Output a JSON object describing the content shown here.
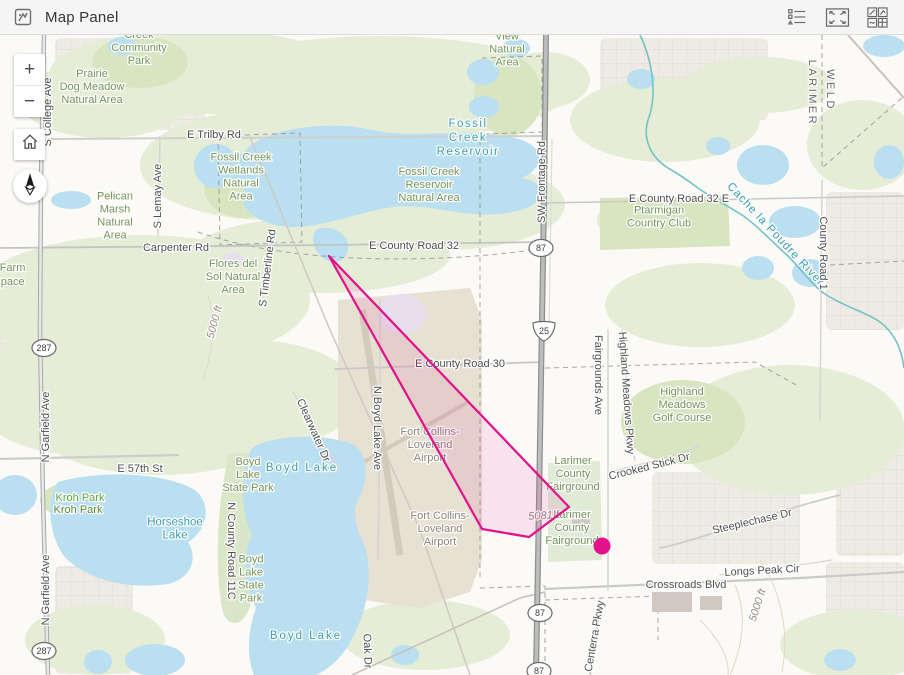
{
  "header": {
    "title": "Map Panel",
    "icons": {
      "panel": "map-panel-icon",
      "legend": "legend-icon",
      "fullscreen": "fullscreen-icon",
      "widgets": "widget-grid-icon"
    }
  },
  "controls": {
    "zoom_in": "+",
    "zoom_out": "−"
  },
  "colors": {
    "accent_pink": "#e2128a",
    "polygon_fill_opacity": 0.1,
    "water": "#badff0",
    "green_pale": "#e5edd7",
    "green_mid": "#d7e5c0",
    "green_mid2": "#d9e6c8",
    "green_fair": "#dfebd6",
    "urban": "#edebe3",
    "grid_line": "#dbd7ce",
    "airport_area": "#e7e1d3",
    "runway": "#d3cbba",
    "contour": "#e1d9c4",
    "river": "#74c2c6",
    "building": "#cfc9c1",
    "road_major": "#9c9c9c",
    "road_minor": "#cccccc",
    "boundary": "#8a8a8a"
  },
  "map": {
    "graphics": {
      "flight_polygon": {
        "points": "329,256 569,507 529,537 482,529 458,486"
      },
      "point_marker": {
        "x": 602,
        "y": 546,
        "r": 8.5
      }
    },
    "urban_blocks": [
      [
        55,
        38,
        150,
        92
      ],
      [
        600,
        38,
        168,
        82
      ],
      [
        826,
        192,
        78,
        138
      ],
      [
        0,
        332,
        112,
        92
      ],
      [
        836,
        424,
        68,
        132
      ],
      [
        55,
        566,
        78,
        108
      ],
      [
        652,
        472,
        148,
        92
      ],
      [
        826,
        562,
        78,
        82
      ]
    ],
    "green_areas": [
      {
        "e": [
          200,
          72,
          150,
          42
        ],
        "c": "green_pale"
      },
      {
        "e": [
          105,
          100,
          85,
          38
        ],
        "c": "green_pale"
      },
      {
        "e": [
          380,
          88,
          190,
          52
        ],
        "c": "green_pale"
      },
      {
        "e": [
          270,
          165,
          130,
          55
        ],
        "c": "green_pale"
      },
      {
        "e": [
          445,
          205,
          120,
          45
        ],
        "c": "green_pale"
      },
      {
        "e": [
          320,
          255,
          130,
          38
        ],
        "c": "green_pale"
      },
      {
        "e": [
          140,
          300,
          170,
          65
        ],
        "c": "green_pale"
      },
      {
        "e": [
          80,
          390,
          110,
          65
        ],
        "c": "green_pale"
      },
      {
        "e": [
          250,
          395,
          110,
          55
        ],
        "c": "green_pale"
      },
      {
        "e": [
          160,
          430,
          120,
          45
        ],
        "c": "green_pale"
      },
      {
        "e": [
          665,
          120,
          95,
          42
        ],
        "c": "green_pale"
      },
      {
        "e": [
          760,
          85,
          75,
          28
        ],
        "c": "green_pale"
      },
      {
        "e": [
          862,
          145,
          55,
          45
        ],
        "c": "green_pale"
      },
      {
        "e": [
          700,
          305,
          95,
          42
        ],
        "c": "green_pale"
      },
      {
        "e": [
          790,
          430,
          115,
          65
        ],
        "c": "green_pale"
      },
      {
        "e": [
          855,
          645,
          75,
          35
        ],
        "c": "green_pale"
      },
      {
        "e": [
          425,
          635,
          85,
          35
        ],
        "c": "green_pale"
      },
      {
        "e": [
          95,
          640,
          70,
          35
        ],
        "c": "green_pale"
      },
      {
        "e": [
          545,
          80,
          45,
          28
        ],
        "c": "green_pale"
      },
      {
        "e": [
          625,
          220,
          28,
          18
        ],
        "c": "green_pale"
      },
      {
        "d": "M600,198 L728,196 L730,246 L600,250 Z",
        "c": "green_mid"
      },
      {
        "e": [
          683,
          422,
          62,
          42
        ],
        "c": "green_mid"
      },
      {
        "e": [
          140,
          62,
          48,
          26
        ],
        "c": "green_mid"
      },
      {
        "e": [
          86,
          500,
          46,
          20
        ],
        "c": "green_mid"
      },
      {
        "e": [
          508,
          96,
          34,
          40
        ],
        "c": "green_mid"
      },
      {
        "e": [
          244,
          188,
          40,
          30
        ],
        "c": "green_mid"
      },
      {
        "d": "M548,463 L600,461 L602,560 L548,562 Z",
        "c": "green_fair"
      },
      {
        "d": "M228,455 C255,448 268,460 262,480 C275,490 268,515 252,520 C262,535 255,555 240,560 C255,570 258,595 246,615 C238,628 225,625 222,608 C215,570 218,520 222,490 Z",
        "c": "green_mid2"
      }
    ],
    "airport_area": {
      "d": "M338,300 L470,288 L482,320 L482,560 L470,592 L420,608 L362,600 L338,480 Z",
      "runways": [
        {
          "d": "M362,310 L400,555",
          "w": 7
        },
        {
          "d": "M350,470 L468,402",
          "w": 4
        }
      ]
    },
    "lavender_areas": [
      {
        "e": [
          402,
          314,
          24,
          20
        ]
      },
      {
        "e": [
          233,
          260,
          11,
          8
        ]
      }
    ],
    "contour_lines": [
      "M735,585 C748,615 742,648 730,675",
      "M760,560 C780,590 790,630 782,672",
      "M208,295 C216,325 212,355 203,380",
      "M700,620 C720,640 730,660 728,675"
    ],
    "lakes": [
      {
        "d": "M244,152 C262,128 330,120 372,130 C415,140 468,126 515,138 C548,146 544,168 522,178 C552,184 546,206 512,212 C470,222 428,200 386,208 C346,216 304,234 272,224 C242,216 236,196 248,184 C224,178 226,160 244,152 Z"
      },
      {
        "e": [
          216,
          166,
          22,
          22
        ]
      },
      {
        "d": "M316,230 C328,224 344,230 348,244 C350,258 338,266 326,260 C314,254 310,238 316,230 Z"
      },
      {
        "e": [
          483,
          72,
          16,
          13
        ]
      },
      {
        "e": [
          516,
          48,
          14,
          9
        ]
      },
      {
        "e": [
          484,
          107,
          15,
          11
        ]
      },
      {
        "e": [
          122,
          46,
          14,
          9
        ]
      },
      {
        "e": [
          71,
          200,
          20,
          9
        ]
      },
      {
        "e": [
          763,
          165,
          26,
          20
        ]
      },
      {
        "e": [
          718,
          146,
          12,
          9
        ]
      },
      {
        "e": [
          795,
          222,
          26,
          16
        ]
      },
      {
        "e": [
          758,
          268,
          16,
          12
        ]
      },
      {
        "e": [
          810,
          273,
          18,
          14
        ]
      },
      {
        "e": [
          889,
          162,
          15,
          17
        ]
      },
      {
        "e": [
          884,
          46,
          21,
          11
        ]
      },
      {
        "e": [
          641,
          79,
          14,
          10
        ]
      },
      {
        "d": "M58,482 C100,470 165,472 195,490 C212,504 208,530 188,542 C198,558 192,578 168,584 C130,590 85,580 64,556 C48,534 46,496 58,482 Z"
      },
      {
        "e": [
          15,
          495,
          22,
          20
        ]
      },
      {
        "d": "M252,448 C270,436 320,432 352,444 C368,452 370,478 358,500 C352,512 356,528 364,544 C372,564 370,600 358,626 C348,652 332,668 316,675 L254,675 C246,656 248,630 256,608 C244,586 242,556 252,534 C240,512 240,470 252,448 Z"
      },
      {
        "e": [
          155,
          660,
          30,
          16
        ]
      },
      {
        "e": [
          98,
          662,
          14,
          12
        ]
      },
      {
        "e": [
          405,
          655,
          14,
          10
        ]
      },
      {
        "e": [
          840,
          660,
          16,
          11
        ]
      }
    ],
    "boundaries": [
      "M480,140 L480,580",
      "M218,136 L300,133 L302,242 L220,245 Z",
      "M482,58 L542,56 L542,132 L482,134",
      "M198,232 C300,268 460,262 545,248",
      "M822,35 L822,168 L904,96",
      "M545,368 L755,362 L798,386",
      "M830,265 L904,261",
      "M480,588 L545,586 L545,672",
      "M545,600 L658,596 L658,640"
    ],
    "roads": [
      {
        "d": "M48,139 L543,136",
        "w": 2,
        "c": "#cfcfcf"
      },
      {
        "d": "M0,248 L330,245 L543,242",
        "w": 1.8,
        "c": "#c4c4c4"
      },
      {
        "d": "M545,203 L904,196",
        "w": 1.5,
        "c": "#c9c9c9"
      },
      {
        "d": "M335,369 L543,362",
        "w": 1.8,
        "c": "#c9c9c9"
      },
      {
        "d": "M0,459 L178,455",
        "w": 2.2,
        "c": "#cdcdcd"
      },
      {
        "d": "M545,589 L800,578 L904,572",
        "w": 2.2,
        "c": "#c9c9c9"
      },
      {
        "d": "M608,330 L608,590",
        "w": 1.5,
        "c": "#d4d4d4"
      },
      {
        "d": "M380,300 L380,430 L378,560",
        "w": 1.5,
        "c": "#d4d4d4"
      },
      {
        "d": "M250,137 L330,330 L420,530 L470,675",
        "w": 1.5,
        "c": "#cfc9c0"
      },
      {
        "d": "M160,137 L158,235",
        "w": 1.5,
        "c": "#d4d4d4"
      },
      {
        "d": "M822,180 L820,420",
        "w": 1.5,
        "c": "#d6d6d6"
      },
      {
        "d": "M622,330 C630,370 622,420 635,460",
        "w": 1.5,
        "c": "#d6d6d6"
      },
      {
        "d": "M660,548 C700,540 760,515 840,495",
        "w": 1.8,
        "c": "#cdcdcd"
      },
      {
        "d": "M848,35 L904,98",
        "w": 2,
        "c": "#c9c2b8"
      },
      {
        "d": "M352,675 L520,598 L545,592",
        "w": 1.5,
        "c": "#c6c0b6"
      },
      {
        "d": "M293,392 L340,470",
        "w": 1.5,
        "c": "#d6d6d6"
      },
      {
        "d": "M600,600 Q596,640 590,675",
        "w": 2,
        "c": "#d0d0d0"
      },
      {
        "d": "M610,472 C650,462 680,455 700,445",
        "w": 1.3,
        "c": "#d6d6d6"
      },
      {
        "d": "M720,575 C760,568 800,566 832,560",
        "w": 1.3,
        "c": "#d6d6d6"
      },
      {
        "d": "M552,140 L549,330",
        "w": 1.2,
        "c": "#dcdcdc"
      }
    ],
    "highway": {
      "d": "M546,35 L544,200 L541,380 L538,560 L536,675",
      "casing": "#8f8f8f",
      "fill": "#bdbdbd"
    },
    "us287_road": {
      "d": "M44,35 L41,180 L40,330 L43,500 L48,675",
      "casing": "#a8a8a8",
      "fill": "#e8e8e8"
    },
    "river": {
      "d": "M640,35 C652,60 658,95 648,120 C642,140 652,158 668,168 C682,176 690,182 698,188 C715,200 728,206 742,215 C758,226 772,242 788,256 C800,268 810,282 822,292 C842,306 866,312 880,322 C896,334 902,352 904,368"
    },
    "buildings": [
      [
        652,
        592,
        40,
        20
      ],
      [
        572,
        512,
        18,
        12
      ],
      [
        700,
        596,
        22,
        14
      ]
    ],
    "shields": [
      {
        "k": "us",
        "t": "287",
        "x": 44,
        "y": 348
      },
      {
        "k": "us",
        "t": "287",
        "x": 44,
        "y": 651
      },
      {
        "k": "us",
        "t": "87",
        "x": 541,
        "y": 248
      },
      {
        "k": "us",
        "t": "87",
        "x": 540,
        "y": 613
      },
      {
        "k": "us",
        "t": "87",
        "x": 539,
        "y": 671
      },
      {
        "k": "i",
        "t": "25",
        "x": 544,
        "y": 331
      }
    ],
    "labels": [
      {
        "t": "Creek\nCommunity\nPark",
        "x": 139,
        "y": 47,
        "c": "park"
      },
      {
        "t": "Prairie\nDog Meadow\nNatural Area",
        "x": 92,
        "y": 86,
        "c": "park"
      },
      {
        "t": "E Trilby Rd",
        "x": 214,
        "y": 134,
        "c": "road"
      },
      {
        "t": "Fossil Creek\nWetlands\nNatural\nArea",
        "x": 241,
        "y": 176,
        "c": "park"
      },
      {
        "t": "Fossil\nCreek\nReservoir",
        "x": 468,
        "y": 137,
        "c": "water",
        "fs": 12,
        "ls": 1.5
      },
      {
        "t": "Fossil Creek\nReservoir\nNatural Area",
        "x": 429,
        "y": 184,
        "c": "park"
      },
      {
        "t": "Eagle\nView\nNatural\nArea",
        "x": 507,
        "y": 42,
        "c": "park"
      },
      {
        "t": "SW Frontage Rd",
        "x": 541,
        "y": 182,
        "c": "road",
        "r": -90
      },
      {
        "t": "LARIMER",
        "x": 813,
        "y": 93,
        "c": "county",
        "r": 90
      },
      {
        "t": "WELD",
        "x": 831,
        "y": 90,
        "c": "county",
        "r": 90
      },
      {
        "t": "E County Road 32 E",
        "x": 679,
        "y": 198,
        "c": "road"
      },
      {
        "t": "Ptarmigan\nCountry Club",
        "x": 659,
        "y": 216,
        "c": "park"
      },
      {
        "t": "Cache la Poudre River",
        "x": 776,
        "y": 234,
        "c": "water",
        "r": 47,
        "ls": 1
      },
      {
        "t": "County Road 1",
        "x": 824,
        "y": 253,
        "c": "road",
        "r": 90
      },
      {
        "t": "E County Road 32",
        "x": 414,
        "y": 245,
        "c": "road"
      },
      {
        "t": "Carpenter Rd",
        "x": 176,
        "y": 247,
        "c": "road"
      },
      {
        "t": "Pelican\nMarsh\nNatural\nArea",
        "x": 115,
        "y": 215,
        "c": "park"
      },
      {
        "t": "S Lemay Ave",
        "x": 157,
        "y": 196,
        "c": "road",
        "r": -90
      },
      {
        "t": "Flores del\nSol Natural\nArea",
        "x": 233,
        "y": 276,
        "c": "park"
      },
      {
        "t": "S Timberline Rd",
        "x": 267,
        "y": 268,
        "c": "road",
        "r": -83
      },
      {
        "t": "5000 ft",
        "x": 214,
        "y": 322,
        "c": "contour",
        "r": -75
      },
      {
        "t": "N Garfield Ave",
        "x": 45,
        "y": 427,
        "c": "road",
        "r": -90
      },
      {
        "t": "N Garfield Ave",
        "x": 45,
        "y": 590,
        "c": "road",
        "r": -90
      },
      {
        "t": "S College Ave",
        "x": 47,
        "y": 112,
        "c": "road",
        "r": -90
      },
      {
        "t": "E 57th St",
        "x": 140,
        "y": 468,
        "c": "road"
      },
      {
        "t": "Kroh Park",
        "x": 80,
        "y": 497,
        "c": "park2"
      },
      {
        "t": "Kroh Park",
        "x": 78,
        "y": 509,
        "c": "park3"
      },
      {
        "t": "Horseshoe\nLake",
        "x": 175,
        "y": 528,
        "c": "water"
      },
      {
        "t": "Boyd\nLake\nState Park",
        "x": 248,
        "y": 474,
        "c": "park"
      },
      {
        "t": "Boyd Lake",
        "x": 302,
        "y": 467,
        "c": "water",
        "fs": 12,
        "ls": 2
      },
      {
        "t": "N County Road 11C",
        "x": 232,
        "y": 551,
        "c": "road",
        "r": 90
      },
      {
        "t": "N Boyd Lake Ave",
        "x": 378,
        "y": 428,
        "c": "road",
        "r": 90
      },
      {
        "t": "Clearwater Dr",
        "x": 314,
        "y": 430,
        "c": "road",
        "r": 66
      },
      {
        "t": "Boyd\nLake\nState\nPark",
        "x": 251,
        "y": 578,
        "c": "park"
      },
      {
        "t": "Boyd Lake",
        "x": 306,
        "y": 635,
        "c": "water",
        "fs": 12,
        "ls": 2
      },
      {
        "t": "Oak Dr",
        "x": 368,
        "y": 651,
        "c": "road",
        "r": 88
      },
      {
        "t": "E County Road 30",
        "x": 460,
        "y": 363,
        "c": "road"
      },
      {
        "t": "Fort Collins-\nLoveland\nAirport",
        "x": 430,
        "y": 444,
        "c": "airport"
      },
      {
        "t": "Fort Collins-\nLoveland\nAirport",
        "x": 440,
        "y": 528,
        "c": "airport"
      },
      {
        "t": "Larimer\nCounty\nFairground",
        "x": 573,
        "y": 473,
        "c": "park"
      },
      {
        "t": "5081 ft",
        "x": 545,
        "y": 515,
        "c": "contour",
        "r": -3
      },
      {
        "t": "Larimer\nCounty\nFairground",
        "x": 572,
        "y": 527,
        "c": "park"
      },
      {
        "t": "Crooked Stick Dr",
        "x": 649,
        "y": 466,
        "c": "road",
        "r": -14
      },
      {
        "t": "Highland\nMeadows\nGolf Course",
        "x": 682,
        "y": 404,
        "c": "park"
      },
      {
        "t": "Highland Meadows Pkwy",
        "x": 627,
        "y": 393,
        "c": "road",
        "r": 86
      },
      {
        "t": "Fairgrounds Ave",
        "x": 599,
        "y": 375,
        "c": "road",
        "r": 90
      },
      {
        "t": "Steeplechase Dr",
        "x": 752,
        "y": 521,
        "c": "road",
        "r": -13
      },
      {
        "t": "Longs Peak Cir",
        "x": 762,
        "y": 570,
        "c": "road",
        "r": -3
      },
      {
        "t": "Crossroads Blvd",
        "x": 686,
        "y": 584,
        "c": "road"
      },
      {
        "t": "5000 ft",
        "x": 757,
        "y": 605,
        "c": "contour",
        "r": -72
      },
      {
        "t": "Centerra Pkwy",
        "x": 594,
        "y": 636,
        "c": "road",
        "r": -80
      },
      {
        "t": "New Farm",
        "x": 0,
        "y": 267,
        "c": "park"
      },
      {
        "t": "Open Space",
        "x": -6,
        "y": 281,
        "c": "park"
      }
    ]
  }
}
